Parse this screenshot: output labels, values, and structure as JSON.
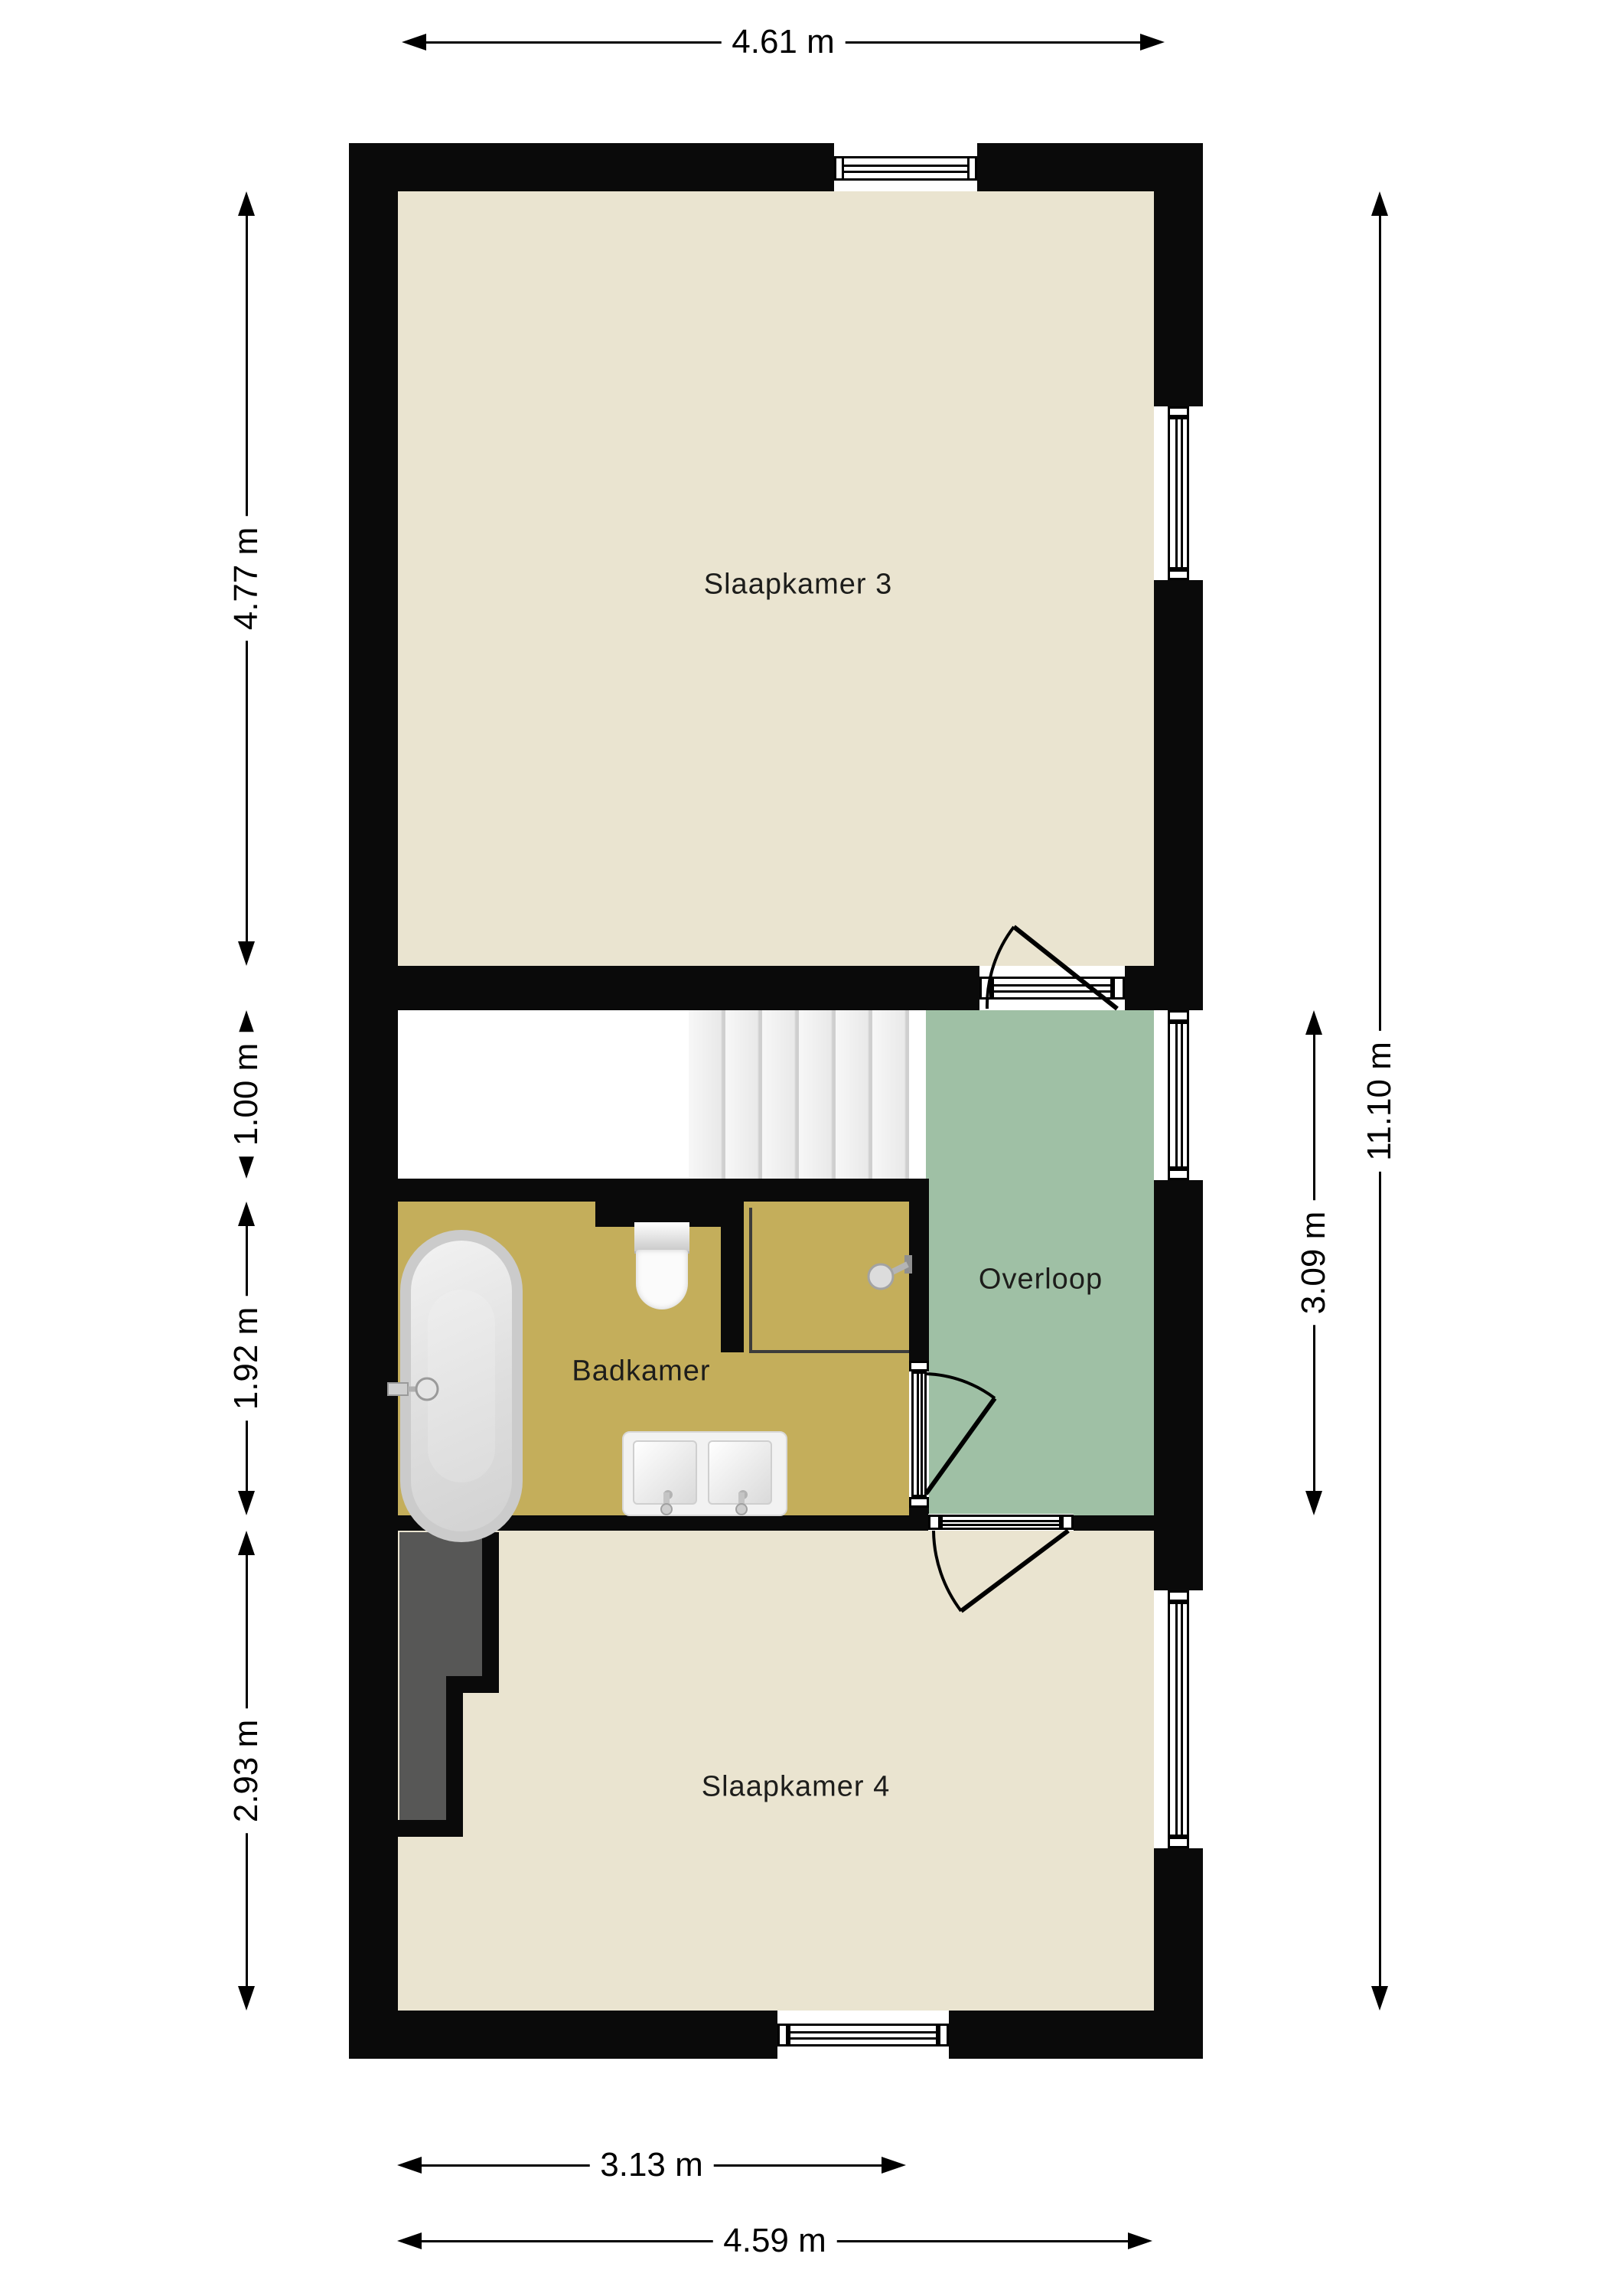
{
  "plan": {
    "type": "floor-plan",
    "rooms": [
      {
        "id": "slaapkamer-3",
        "label": "Slaapkamer 3",
        "floor_color": "#eae4d0"
      },
      {
        "id": "badkamer",
        "label": "Badkamer",
        "floor_color": "#c4ae5b"
      },
      {
        "id": "overloop",
        "label": "Overloop",
        "floor_color": "#9fc0a5"
      },
      {
        "id": "slaapkamer-4",
        "label": "Slaapkamer 4",
        "floor_color": "#eae4d0"
      }
    ],
    "dimensions": {
      "top": [
        {
          "label": "4.61 m"
        }
      ],
      "left": [
        {
          "label": "4.77 m"
        },
        {
          "label": "1.00 m"
        },
        {
          "label": "1.92 m"
        },
        {
          "label": "2.93 m"
        }
      ],
      "right": [
        {
          "label": "3.09 m"
        },
        {
          "label": "11.10 m"
        }
      ],
      "bottom": [
        {
          "label": "3.13 m"
        },
        {
          "label": "4.59 m"
        }
      ]
    },
    "fixtures": [
      {
        "name": "bathtub"
      },
      {
        "name": "toilet"
      },
      {
        "name": "double-sink"
      },
      {
        "name": "shower-head"
      },
      {
        "name": "staircase"
      },
      {
        "name": "chimney"
      }
    ],
    "symbols": {
      "windows": 5,
      "doors": 3
    },
    "colors": {
      "wall": "#0a0a0a",
      "bedroom_floor": "#eae4d0",
      "bathroom_floor": "#c4ae5b",
      "hallway_floor": "#9fc0a5",
      "stairs_floor": "#ececec",
      "chimney": "#575756",
      "dimension_line": "#000000",
      "label_text": "#1d1d1b"
    }
  }
}
